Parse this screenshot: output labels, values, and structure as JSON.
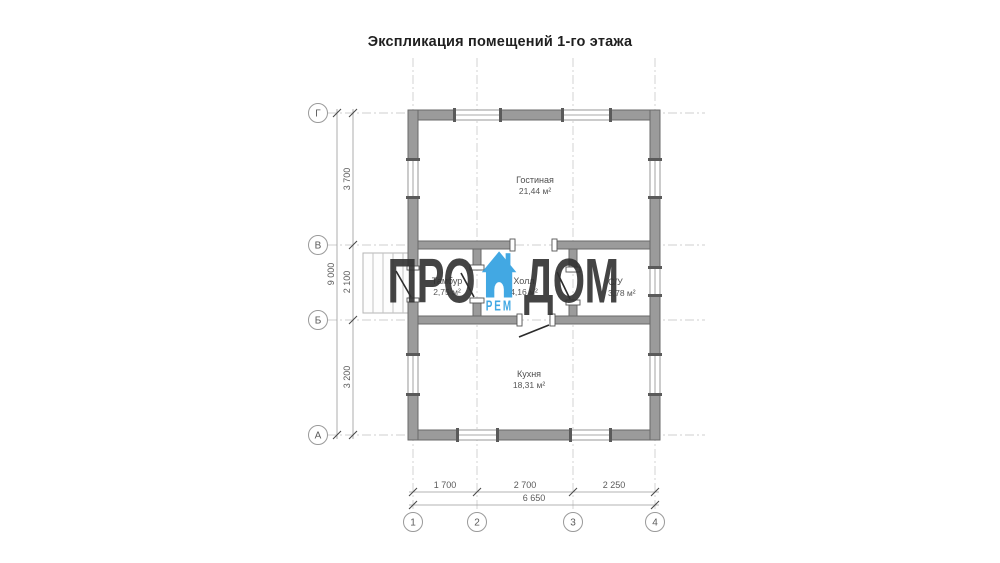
{
  "title": "Экспликация помещений 1-го этажа",
  "watermark": {
    "text_left": "ПРО",
    "text_right": "ДОМ",
    "text_sub": "РЕМ",
    "icon": "house-icon",
    "accent_color": "#2e9fe0",
    "text_color": "#303030"
  },
  "rooms": {
    "living": {
      "name": "Гостиная",
      "area": "21,44 м²"
    },
    "tambour": {
      "name": "Тамбур",
      "area": "2,75 м²"
    },
    "hall": {
      "name": "Холл",
      "area": "4,16 м²"
    },
    "wc": {
      "name": "С/У",
      "area": "3,78 м²"
    },
    "kitchen": {
      "name": "Кухня",
      "area": "18,31 м²"
    }
  },
  "axes": {
    "rows": [
      "Г",
      "В",
      "Б",
      "А"
    ],
    "cols": [
      "1",
      "2",
      "3",
      "4"
    ]
  },
  "dimensions": {
    "left": {
      "segments": [
        "3 700",
        "2 100",
        "3 200"
      ],
      "total": "9 000"
    },
    "bottom": {
      "segments": [
        "1 700",
        "2 700",
        "2 250"
      ],
      "total": "6 650"
    }
  },
  "colors": {
    "wall_fill": "#9b9b9b",
    "wall_stroke": "#696969",
    "grid": "#cfcfcf",
    "dimension": "#9a9a9a",
    "label_text": "#4f4f4f"
  }
}
